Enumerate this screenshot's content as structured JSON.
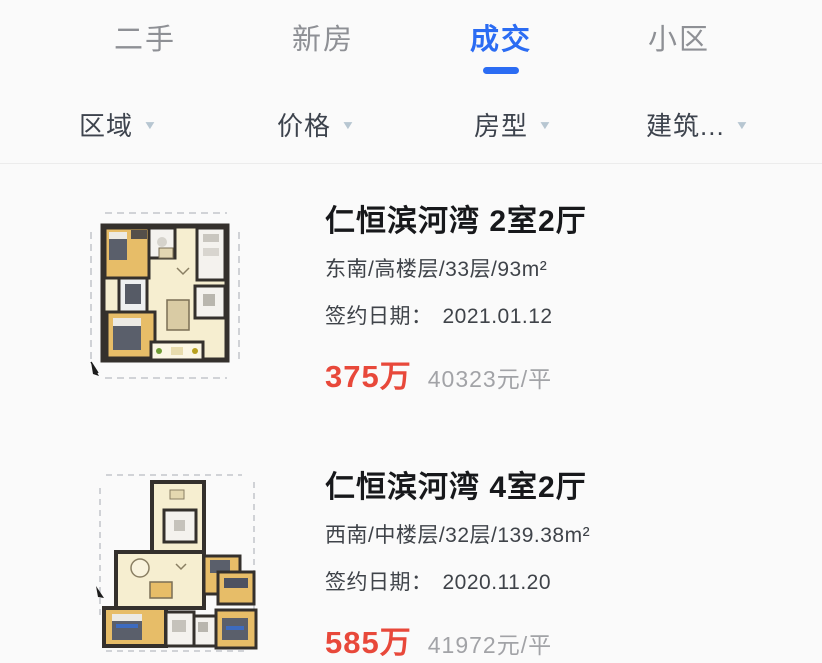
{
  "tabs": [
    {
      "label": "二手",
      "active": false
    },
    {
      "label": "新房",
      "active": false
    },
    {
      "label": "成交",
      "active": true
    },
    {
      "label": "小区",
      "active": false
    }
  ],
  "filters": [
    {
      "label": "区域"
    },
    {
      "label": "价格"
    },
    {
      "label": "房型"
    },
    {
      "label": "建筑..."
    }
  ],
  "icons": {
    "dropdown_arrow": "▼"
  },
  "listings": [
    {
      "title": "仁恒滨河湾 2室2厅",
      "specs": "东南/高楼层/33层/93m²",
      "date_label": "签约日期：",
      "date": "2021.01.12",
      "price": "375万",
      "unit_price": "40323元/平"
    },
    {
      "title": "仁恒滨河湾 4室2厅",
      "specs": "西南/中楼层/32层/139.38m²",
      "date_label": "签约日期：",
      "date": "2020.11.20",
      "price": "585万",
      "unit_price": "41972元/平"
    }
  ],
  "colors": {
    "accent_blue": "#2b6cf3",
    "price_red": "#e8483a",
    "inactive_tab_gray": "#8e9095",
    "unit_price_gray": "#a2a3a7"
  }
}
